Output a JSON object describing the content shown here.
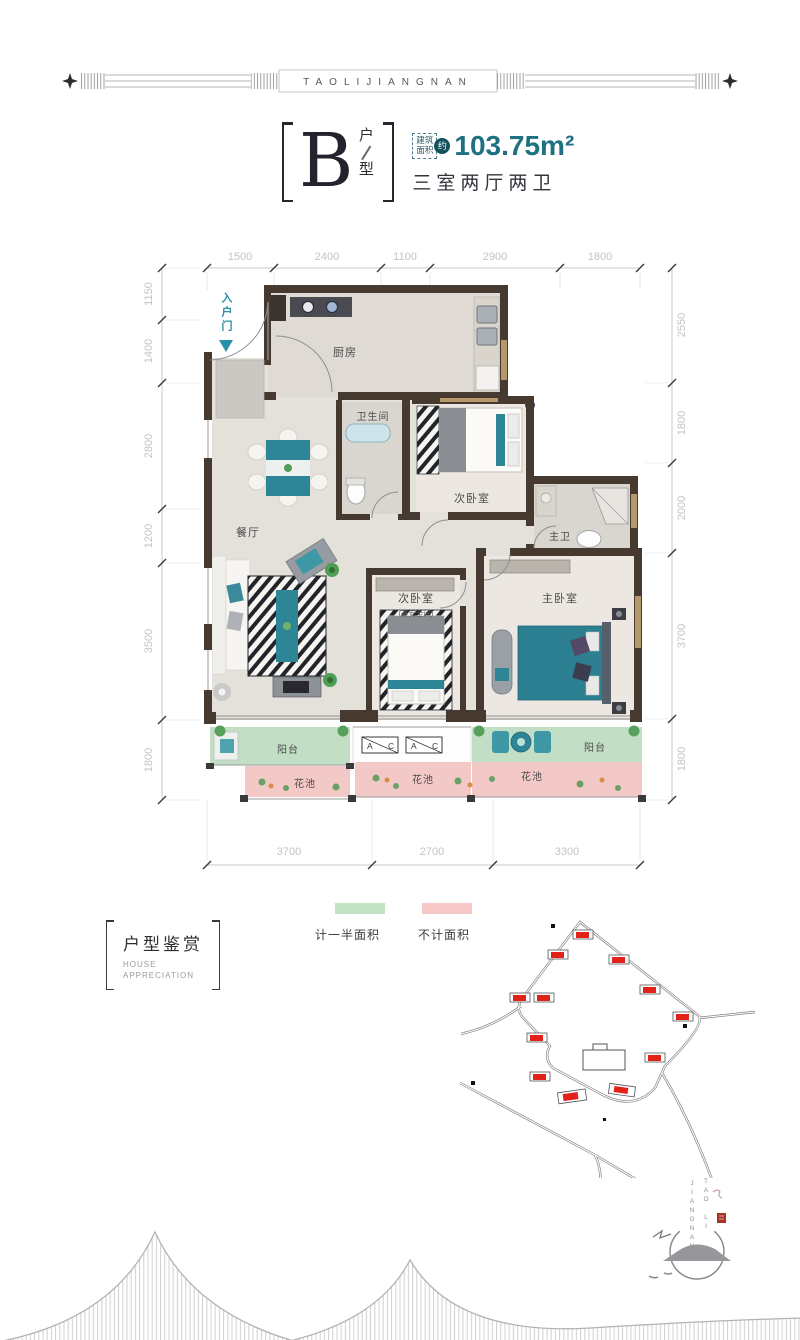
{
  "brand": {
    "banner_text": "TAOLIJIANGNAN",
    "logo_line1": "TAO LI",
    "logo_line2": "JIANGNAN"
  },
  "title": {
    "unit_letter": "B",
    "unit_char_top": "户",
    "unit_char_bottom": "型",
    "area_label_line1": "建筑",
    "area_label_line2": "面积",
    "area_approx": "约",
    "area_value": "103.75m²",
    "layout_desc": "三室两厅两卫"
  },
  "plan": {
    "entry_label": "入户门",
    "dims": {
      "top": [
        "1500",
        "2400",
        "1100",
        "2900",
        "1800"
      ],
      "left": [
        "1150",
        "1400",
        "2800",
        "1200",
        "3500",
        "1800"
      ],
      "right": [
        "2550",
        "1800",
        "2000",
        "3700",
        "1800"
      ],
      "bottom": [
        "3700",
        "2700",
        "3300"
      ]
    },
    "rooms": {
      "kitchen": "厨房",
      "bathroom": "卫生间",
      "bedroom_ne": "次卧室",
      "master_bath": "主卫",
      "dining": "餐厅",
      "bedroom_mid": "次卧室",
      "bedroom_mid_note": "(兼安全间)",
      "master_bedroom": "主卧室",
      "balcony_left": "阳台",
      "balcony_right": "阳台",
      "flower_1": "花池",
      "flower_2": "花池",
      "flower_3": "花池"
    },
    "ac_a": "A",
    "ac_c": "C"
  },
  "legend": {
    "half_area": "计一半面积",
    "not_counted": "不计面积"
  },
  "section": {
    "title": "户型鉴赏",
    "sub_line1": "HOUSE",
    "sub_line2": "APPRECIATION"
  },
  "colors": {
    "teal_accent": "#1e7180",
    "wall": "#46392f",
    "balcony_green": "#c2dfc6",
    "flower_pink": "#f2c9c6",
    "site_red": "#e32119"
  }
}
